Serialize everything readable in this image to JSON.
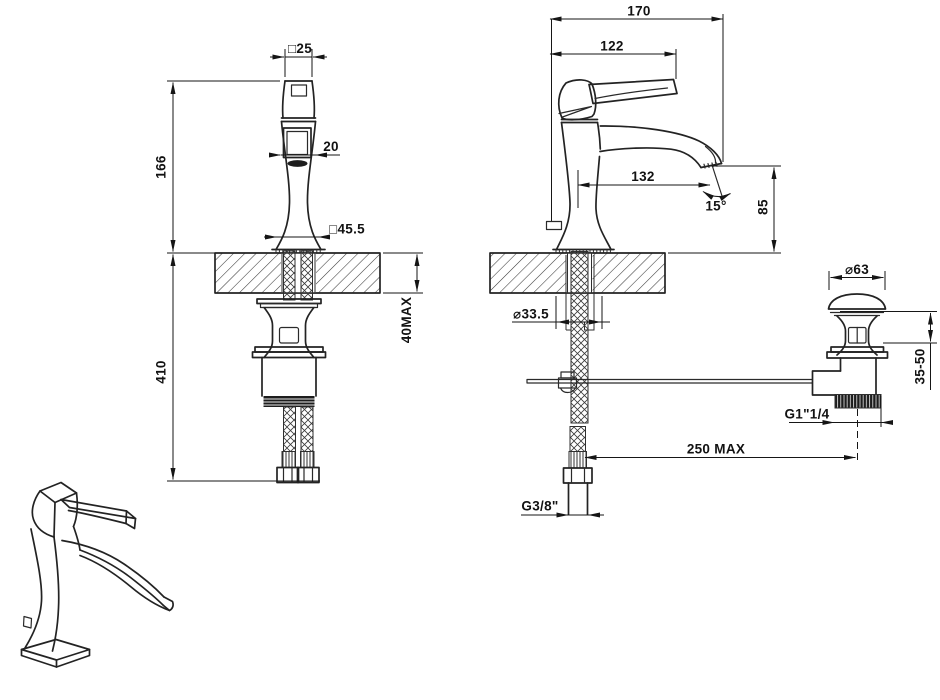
{
  "meta": {
    "background_color": "#ffffff",
    "line_color": "#1d1d1d",
    "drawing_views": [
      "front elevation",
      "side elevation with pop-up waste",
      "isometric sketch"
    ]
  },
  "dims": {
    "front": {
      "handle_square": "□25",
      "height_above": "166",
      "outlet": "20",
      "base_square": "□45.5",
      "counter_max": "40MAX",
      "height_below": "410"
    },
    "side": {
      "overall_depth": "170",
      "handle_depth": "122",
      "spout_reach": "132",
      "flow_angle": "15°",
      "outlet_height": "85",
      "hole_diameter": "⌀33.5",
      "supply_thread": "G3/8\"",
      "rod_max": "250  MAX"
    },
    "waste": {
      "cap_diameter": "⌀63",
      "height_range": "35-50",
      "outlet_thread": "G1\"1/4"
    }
  }
}
